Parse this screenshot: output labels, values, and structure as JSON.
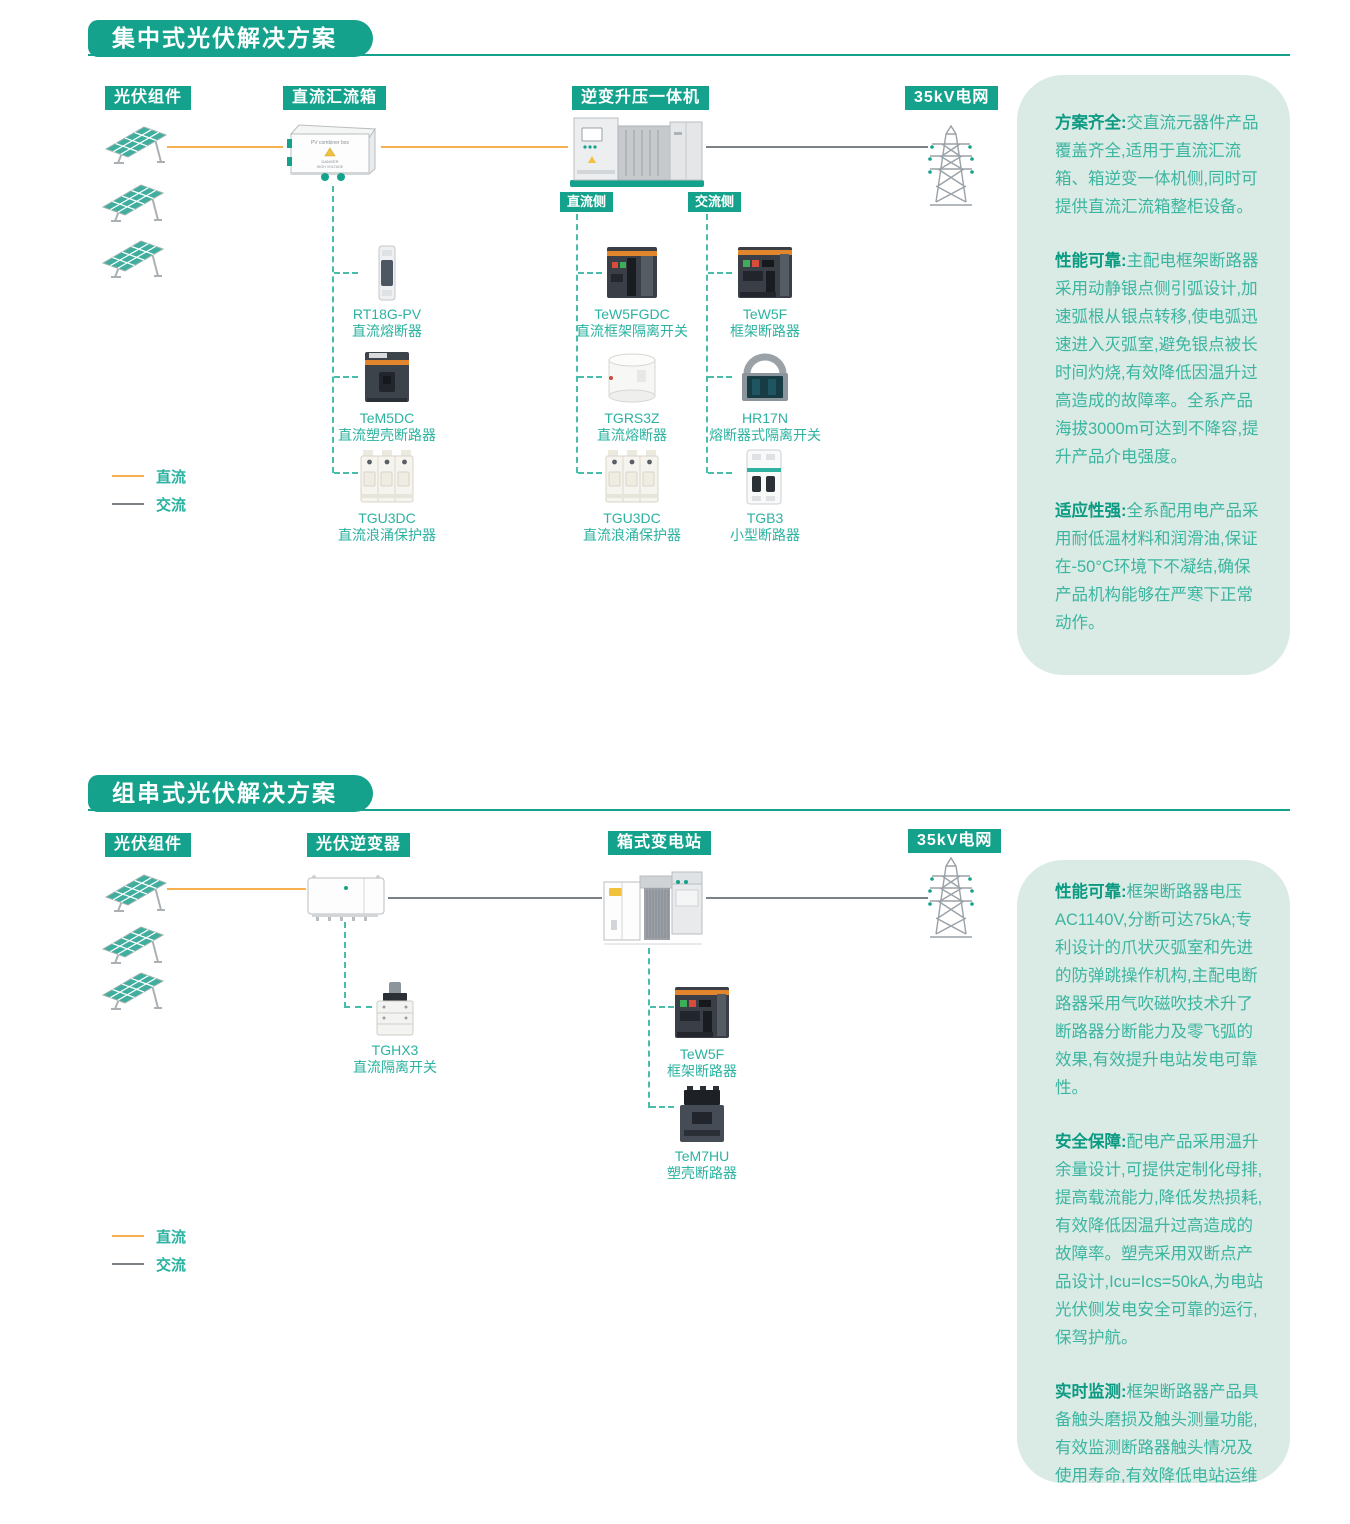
{
  "colors": {
    "accent": "#14a28c",
    "panel_bg": "#d9ebe4",
    "dc_line": "#f6b04e",
    "ac_line": "#7c8186",
    "lead_text": "#0c9a83",
    "body_text": "#3cb5a1"
  },
  "s1": {
    "title": "集中式光伏解决方案",
    "nodes": {
      "pv": "光伏组件",
      "combiner": "直流汇流箱",
      "inverter": "逆变升压一体机",
      "grid": "35kV电网"
    },
    "sides": {
      "dc": "直流侧",
      "ac": "交流侧"
    },
    "combiner_box": {
      "label": "PV combiner box",
      "warn1": "DANGER",
      "warn2": "HIGH VOLTAGE"
    },
    "products": {
      "combiner": [
        {
          "model": "RT18G-PV",
          "name": "直流熔断器"
        },
        {
          "model": "TeM5DC",
          "name": "直流塑壳断路器"
        },
        {
          "model": "TGU3DC",
          "name": "直流浪涌保护器"
        }
      ],
      "dc_side": [
        {
          "model": "TeW5FGDC",
          "name": "直流框架隔离开关"
        },
        {
          "model": "TGRS3Z",
          "name": "直流熔断器"
        },
        {
          "model": "TGU3DC",
          "name": "直流浪涌保护器"
        }
      ],
      "ac_side": [
        {
          "model": "TeW5F",
          "name": "框架断路器"
        },
        {
          "model": "HR17N",
          "name": "熔断器式隔离开关"
        },
        {
          "model": "TGB3",
          "name": "小型断路器"
        }
      ]
    },
    "legend": {
      "dc": "直流",
      "ac": "交流"
    },
    "panel": [
      {
        "lead": "方案齐全:",
        "body": "交直流元器件产品覆盖齐全,适用于直流汇流箱、箱逆变一体机侧,同时可提供直流汇流箱整柜设备。"
      },
      {
        "lead": "性能可靠:",
        "body": "主配电框架断路器采用动静银点侧引弧设计,加速弧根从银点转移,使电弧迅速进入灭弧室,避免银点被长时间灼烧,有效降低因温升过高造成的故障率。全系产品海拔3000m可达到不降容,提升产品介电强度。"
      },
      {
        "lead": "适应性强:",
        "body": "全系配用电产品采用耐低温材料和润滑油,保证在-50°C环境下不凝结,确保产品机构能够在严寒下正常动作。"
      }
    ]
  },
  "s2": {
    "title": "组串式光伏解决方案",
    "nodes": {
      "pv": "光伏组件",
      "inverter": "光伏逆变器",
      "substation": "箱式变电站",
      "grid": "35kV电网"
    },
    "products": {
      "inverter": [
        {
          "model": "TGHX3",
          "name": "直流隔离开关"
        }
      ],
      "substation": [
        {
          "model": "TeW5F",
          "name": "框架断路器"
        },
        {
          "model": "TeM7HU",
          "name": "塑壳断路器"
        }
      ]
    },
    "legend": {
      "dc": "直流",
      "ac": "交流"
    },
    "panel": [
      {
        "lead": "性能可靠:",
        "body": "框架断路器电压AC1140V,分断可达75kA;专利设计的爪状灭弧室和先进的防弹跳操作机构,主配电断路器采用气吹磁吹技术升了断路器分断能力及零飞弧的效果,有效提升电站发电可靠性。"
      },
      {
        "lead": "安全保障:",
        "body": "配电产品采用温升余量设计,可提供定制化母排,提高载流能力,降低发热损耗,有效降低因温升过高造成的故障率。塑壳采用双断点产品设计,Icu=Ics=50kA,为电站光伏侧发电安全可靠的运行,保驾护航。"
      },
      {
        "lead": "实时监测:",
        "body": "框架断路器产品具备触头磨损及触头测量功能,有效监测断路器触头情况及使用寿命,有效降低电站运维成本。"
      }
    ]
  }
}
